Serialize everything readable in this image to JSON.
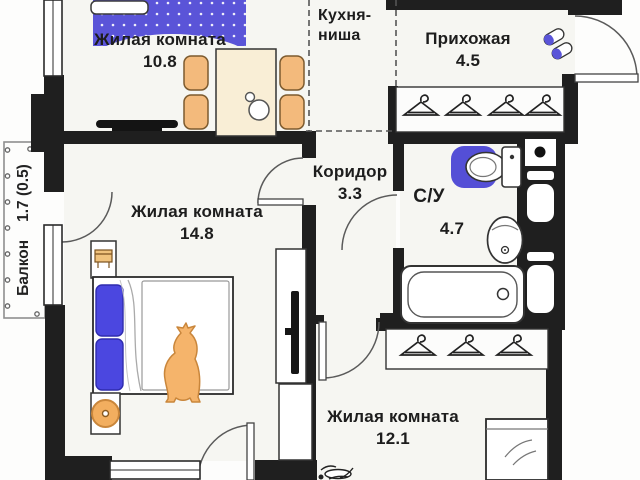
{
  "floor_plan": {
    "title": "Apartment floor plan",
    "rooms": [
      {
        "id": "living-room-1",
        "name": "Жилая комната",
        "area": "10.8"
      },
      {
        "id": "kitchen-niche",
        "name_line1": "Кухня-",
        "name_line2": "ниша"
      },
      {
        "id": "hallway",
        "name": "Прихожая",
        "area": "4.5"
      },
      {
        "id": "corridor",
        "name": "Коридор",
        "area": "3.3"
      },
      {
        "id": "bathroom",
        "name": "С/У",
        "area": "4.7"
      },
      {
        "id": "living-room-2",
        "name": "Жилая комната",
        "area": "14.8"
      },
      {
        "id": "living-room-3",
        "name": "Жилая комната",
        "area": "12.1"
      },
      {
        "id": "balcony",
        "name": "Балкон",
        "area": "1.7 (0.5)"
      }
    ],
    "icons": [
      "sofa-bed",
      "dining-table",
      "chair",
      "tv",
      "slippers",
      "clothes-hanger",
      "toilet",
      "sink",
      "bathtub",
      "vent-shaft",
      "double-bed",
      "single-bed",
      "pet",
      "stool",
      "ceiling-lamp",
      "balcony-railing",
      "door-arc",
      "window"
    ],
    "colors": {
      "wall": "#1f1f1f",
      "accent_blue": "#5a54d8",
      "pillow_blue": "#4b47e0",
      "mat_blue": "#544fd6",
      "furniture_orange": "#f3ba7c",
      "table_cream": "#f9eed6",
      "line": "#2b2b2b"
    }
  }
}
